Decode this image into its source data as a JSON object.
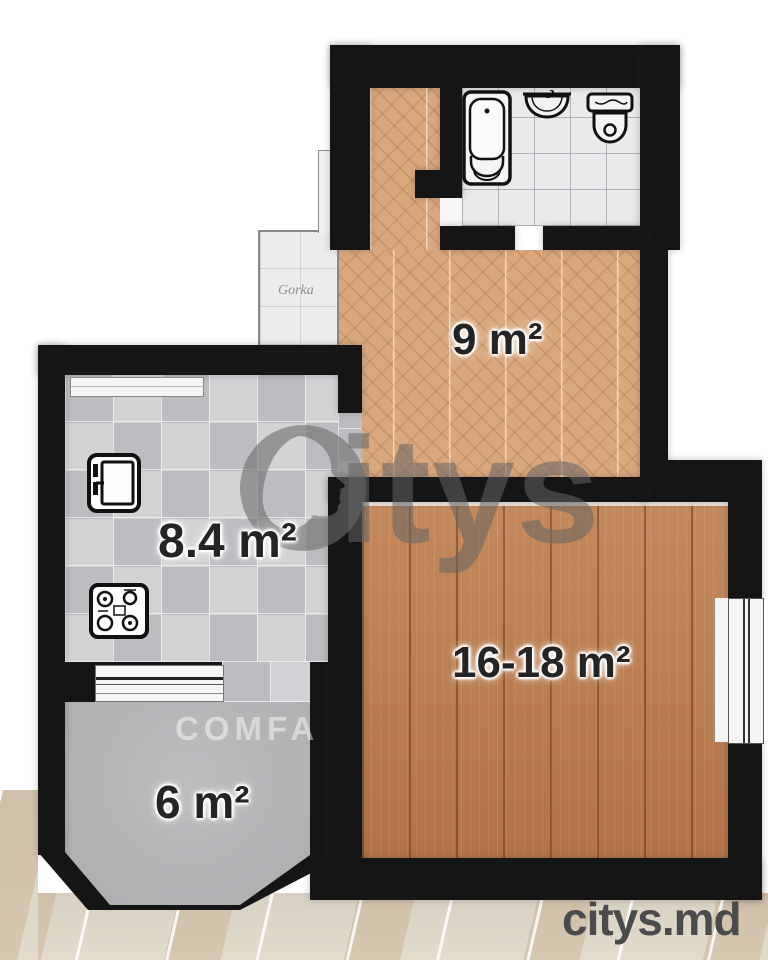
{
  "brand": {
    "watermark_letters": "itys",
    "watermark_full": "citys",
    "corner_logo": "citys.md"
  },
  "rooms": {
    "hallway": {
      "label": "9 m²"
    },
    "kitchen": {
      "label": "8.4 m²"
    },
    "living": {
      "label": "16-18 m²"
    },
    "balcony": {
      "label": "6 m²"
    },
    "porch": {
      "label": "Gorka"
    }
  },
  "overlays": {
    "comfa": "COMFA"
  },
  "icons": [
    "bathtub-icon",
    "sink-icon",
    "toilet-icon",
    "fridge-icon",
    "stove-icon",
    "citys-logo-icon"
  ],
  "colors": {
    "wall": "#151515",
    "hall_parquet": "#dba87d",
    "living_wood": "#bd7b49",
    "kitchen_tile": "#cacace",
    "bath_tile": "#eaeaec",
    "balcony_floor": "#b4b4b7",
    "photo_tile": "#e3dccd",
    "watermark_gray": "#6e6e6e",
    "corner_logo_gray": "#4b4b4b"
  }
}
